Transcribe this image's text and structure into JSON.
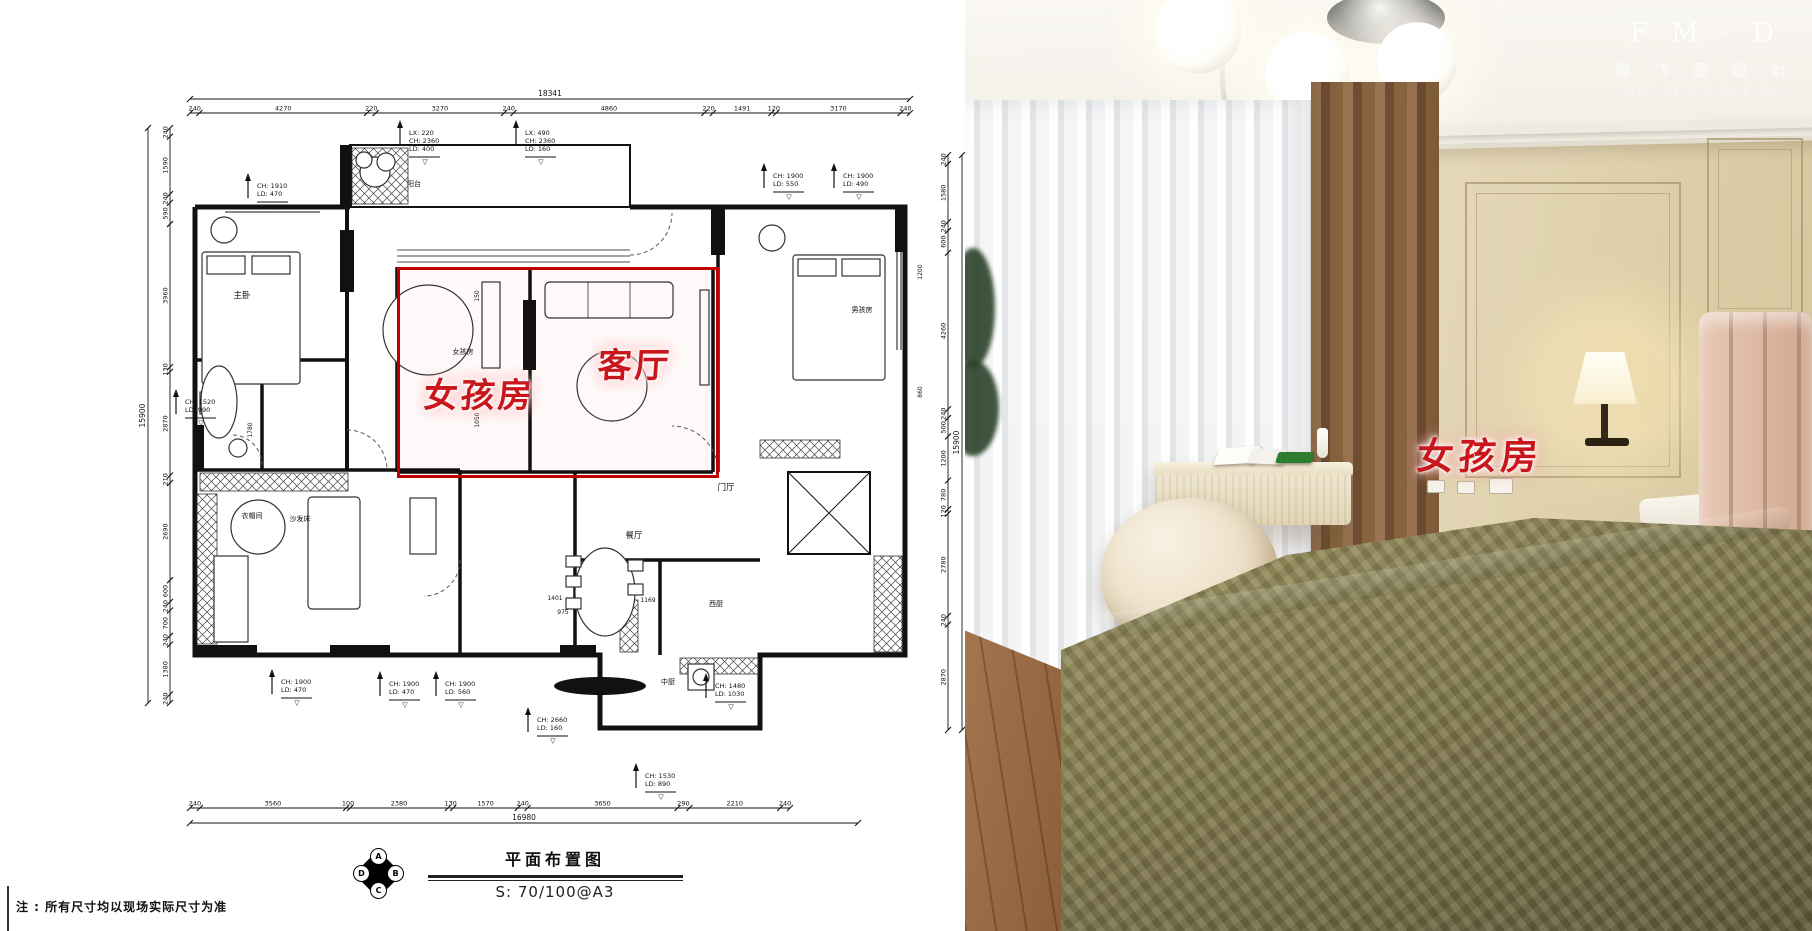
{
  "plan": {
    "title": "平面布置图",
    "scale": "S: 70/100@A3",
    "note": "注 : 所有尺寸均以现场实际尺寸为准",
    "stamp_letters": [
      "A",
      "B",
      "C",
      "D"
    ],
    "highlight": {
      "girl_room": "女孩房",
      "living_room": "客厅"
    },
    "highlight_color": "#c00000",
    "dim_lines": [
      {
        "id": "top-total",
        "axis": "h",
        "at": 99,
        "from": 190,
        "to": 910,
        "labels": [
          "18341"
        ]
      },
      {
        "id": "top-seg",
        "axis": "h",
        "at": 113,
        "from": 190,
        "to": 910,
        "labels": [
          "240",
          "4270",
          "220",
          "3270",
          "240",
          "4860",
          "220",
          "1491",
          "120",
          "3170",
          "240"
        ]
      },
      {
        "id": "bottom-seg",
        "axis": "h",
        "at": 808,
        "from": 190,
        "to": 790,
        "labels": [
          "240",
          "3560",
          "100",
          "2380",
          "130",
          "1570",
          "240",
          "3650",
          "290",
          "2210",
          "240"
        ]
      },
      {
        "id": "bottom-total",
        "axis": "h",
        "at": 823,
        "from": 190,
        "to": 858,
        "labels": [
          "16980"
        ]
      },
      {
        "id": "left-total",
        "axis": "v",
        "at": 148,
        "from": 128,
        "to": 703,
        "labels": [
          "15900"
        ]
      },
      {
        "id": "left-seg",
        "axis": "v",
        "at": 170,
        "from": 128,
        "to": 703,
        "labels": [
          "240",
          "1590",
          "240",
          "590",
          "3960",
          "130",
          "2870",
          "210",
          "2690",
          "600",
          "240",
          "700",
          "240",
          "1380",
          "240"
        ]
      },
      {
        "id": "right-seg",
        "axis": "v",
        "at": 948,
        "from": 155,
        "to": 730,
        "labels": [
          "240",
          "1580",
          "240",
          "600",
          "4260",
          "240",
          "500",
          "1200",
          "780",
          "120",
          "2780",
          "240",
          "2870"
        ]
      },
      {
        "id": "right-total",
        "axis": "v",
        "at": 962,
        "from": 155,
        "to": 730,
        "labels": [
          "15900"
        ]
      }
    ],
    "annotations": [
      {
        "x": 400,
        "y": 135,
        "lines": [
          "LX: 220",
          "CH: 2360",
          "LD: 400"
        ]
      },
      {
        "x": 516,
        "y": 135,
        "lines": [
          "LX: 490",
          "CH: 2360",
          "LD: 160"
        ]
      },
      {
        "x": 764,
        "y": 178,
        "lines": [
          "CH: 1900",
          "LD: 550"
        ]
      },
      {
        "x": 834,
        "y": 178,
        "lines": [
          "CH: 1900",
          "LD: 490"
        ]
      },
      {
        "x": 248,
        "y": 188,
        "lines": [
          "CH: 1910",
          "LD: 470"
        ]
      },
      {
        "x": 176,
        "y": 404,
        "lines": [
          "CH: 1520",
          "LD: 990"
        ]
      },
      {
        "x": 272,
        "y": 684,
        "lines": [
          "CH: 1900",
          "LD: 470"
        ]
      },
      {
        "x": 380,
        "y": 686,
        "lines": [
          "CH: 1900",
          "LD: 470"
        ]
      },
      {
        "x": 436,
        "y": 686,
        "lines": [
          "CH: 1900",
          "LD: 560"
        ]
      },
      {
        "x": 528,
        "y": 722,
        "lines": [
          "CH: 2660",
          "LD: 160"
        ]
      },
      {
        "x": 636,
        "y": 778,
        "lines": [
          "CH: 1530",
          "LD: 890"
        ]
      },
      {
        "x": 706,
        "y": 688,
        "lines": [
          "CH: 1480",
          "LD: 1030"
        ]
      }
    ],
    "room_labels": [
      {
        "x": 242,
        "y": 298,
        "t": "主卧"
      },
      {
        "x": 463,
        "y": 354,
        "t": "女孩房",
        "s": 7
      },
      {
        "x": 862,
        "y": 312,
        "t": "男孩房",
        "s": 7
      },
      {
        "x": 414,
        "y": 186,
        "t": "阳台",
        "s": 7
      },
      {
        "x": 726,
        "y": 490,
        "t": "门厅"
      },
      {
        "x": 634,
        "y": 538,
        "t": "餐厅"
      },
      {
        "x": 716,
        "y": 606,
        "t": "西厨",
        "s": 7
      },
      {
        "x": 668,
        "y": 684,
        "t": "中厨",
        "s": 7
      },
      {
        "x": 252,
        "y": 518,
        "t": "衣帽间",
        "s": 7
      },
      {
        "x": 300,
        "y": 521,
        "t": "沙发床",
        "s": 7
      }
    ],
    "inner_dims": [
      {
        "x": 479,
        "y": 296,
        "t": "150",
        "rot": true
      },
      {
        "x": 479,
        "y": 420,
        "t": "1050",
        "rot": true
      },
      {
        "x": 555,
        "y": 600,
        "t": "1401"
      },
      {
        "x": 648,
        "y": 602,
        "t": "1169"
      },
      {
        "x": 563,
        "y": 614,
        "t": "975"
      },
      {
        "x": 252,
        "y": 430,
        "t": "1780",
        "rot": true
      },
      {
        "x": 922,
        "y": 272,
        "t": "1200",
        "rot": true
      },
      {
        "x": 922,
        "y": 392,
        "t": "860",
        "rot": true
      }
    ]
  },
  "photo": {
    "room_label": "女孩房",
    "label_color": "#c9161c",
    "watermark": {
      "line1": "F M · D",
      "line2": "徽 飞 墨 設 計",
      "line3": "HUI FEIMO DESIGN"
    }
  }
}
